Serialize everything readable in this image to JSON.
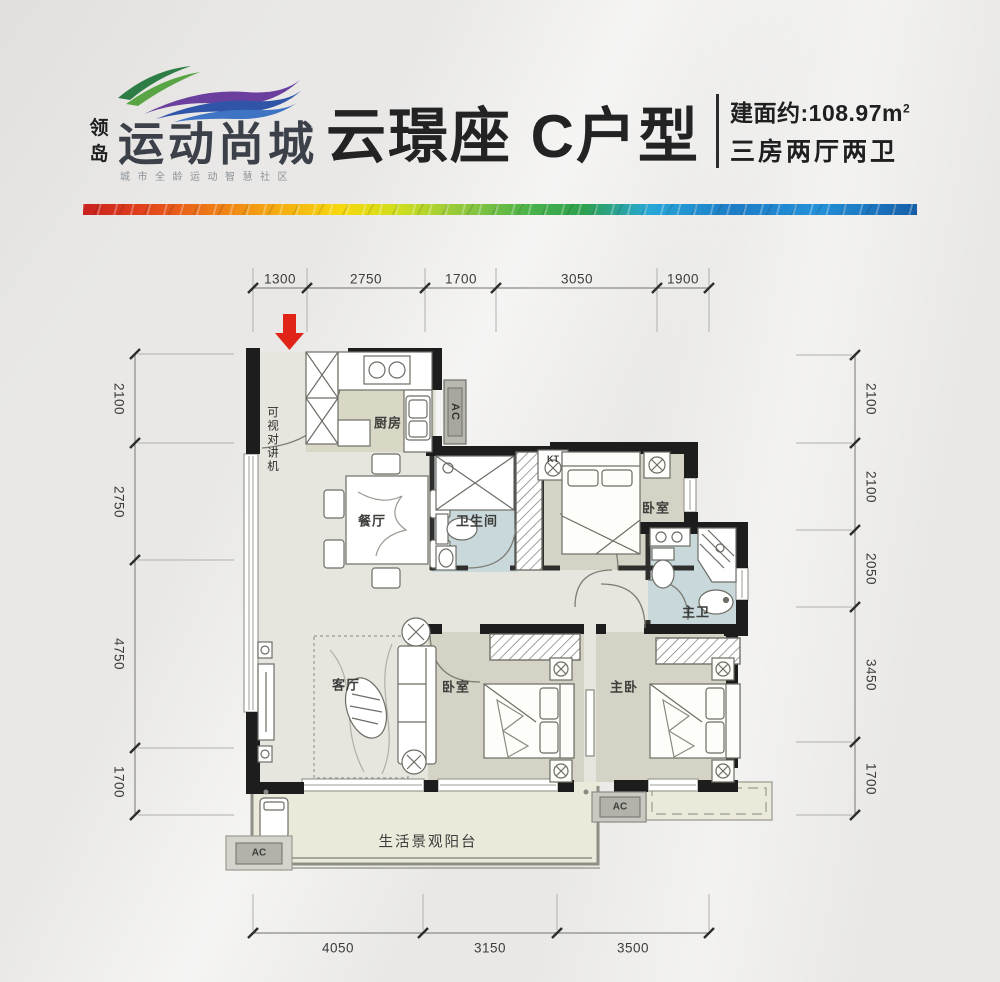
{
  "logo": {
    "seal": "领岛",
    "brand": "运动尚城",
    "tagline": "城市全龄运动智慧社区"
  },
  "header": {
    "title": "云璟座 C户型",
    "area_prefix": "建面约:",
    "area_value": "108.97m",
    "area_sup": "2",
    "spec": "三房两厅两卫"
  },
  "plan": {
    "labels": {
      "kitchen": "厨房",
      "dining": "餐厅",
      "living": "客厅",
      "bath": "卫生间",
      "bedroom_top": "卧室",
      "master_bath": "主卫",
      "bedroom_left": "卧室",
      "master_bedroom": "主卧",
      "balcony": "生活景观阳台",
      "intercom": "可视对讲机",
      "kt": "KT",
      "ac": "AC"
    },
    "dims": {
      "top": [
        "1300",
        "2750",
        "1700",
        "3050",
        "1900"
      ],
      "left": [
        "2100",
        "2750",
        "4750",
        "1700"
      ],
      "right": [
        "2100",
        "2100",
        "2050",
        "3450",
        "1700"
      ],
      "bottom": [
        "4050",
        "3150",
        "3500"
      ]
    }
  },
  "colors": {
    "wall": "#1d1d1d",
    "floor_main": "#e6e5de",
    "floor_room": "#d4d3c5",
    "floor_kitchen": "#d9d8c6",
    "floor_bath": "#c9d8db",
    "floor_balcony": "#ebe9da",
    "arrow": "#e02418"
  }
}
